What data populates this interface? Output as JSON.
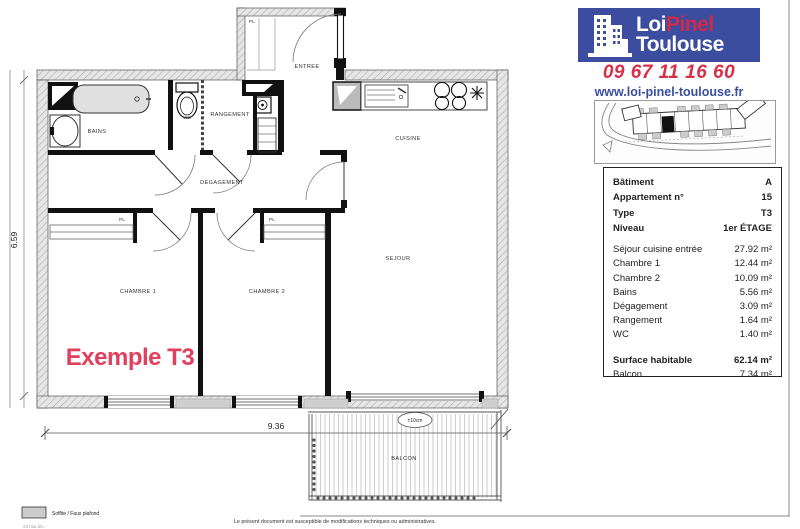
{
  "branding": {
    "logo": {
      "part1": "Loi",
      "part2": "Pinel",
      "line2": "Toulouse"
    },
    "phone": "09 67 11 16 60",
    "website": "www.loi-pinel-toulouse.fr",
    "colors": {
      "logo_bg": "#3c4c9e",
      "logo_accent": "#d02a4a",
      "phone_red": "#d82f48",
      "web_blue": "#3a4fa0",
      "watermark_red": "#e0405e"
    }
  },
  "details_table": {
    "rows": [
      {
        "label": "Bâtiment",
        "value": "A"
      },
      {
        "label": "Appartement n°",
        "value": "15"
      },
      {
        "label": "Type",
        "value": "T3"
      },
      {
        "label": "Niveau",
        "value": "1er ÉTAGE"
      },
      {
        "label": "Séjour cuisine entrée",
        "value": "27.92 m²"
      },
      {
        "label": "Chambre 1",
        "value": "12.44 m²"
      },
      {
        "label": "Chambre 2",
        "value": "10.09 m²"
      },
      {
        "label": "Bains",
        "value": "5.56 m²"
      },
      {
        "label": "Dégagement",
        "value": "3.09 m²"
      },
      {
        "label": "Rangement",
        "value": "1.64 m²"
      },
      {
        "label": "WC",
        "value": "1.40 m²"
      },
      {
        "label": "Surface habitable",
        "value": "62.14 m²"
      },
      {
        "label": "Balcon",
        "value": "7.34 m²"
      }
    ]
  },
  "floor_plan": {
    "rooms": {
      "entree": "ENTREE",
      "pl_entree": "PL",
      "bains": "BAINS",
      "wc": "WC",
      "rangement": "RANGEMENT",
      "degagement": "DEGAGEMENT",
      "cuisine": "CUISINE",
      "sejour": "SEJOUR",
      "chambre1": "CHAMBRE 1",
      "chambre2": "CHAMBRE 2",
      "pl_chambre1": "PL",
      "pl_chambre2": "PL",
      "balcon": "BALCON"
    },
    "dimensions": {
      "width_m": "9.36",
      "height_m": "6.59"
    },
    "balcony_tolerance": "±10cm",
    "watermark": "Exemple T3"
  },
  "legend": {
    "swatch_label": "Soffite / Faux plafond",
    "date_note": "23 mai 20.."
  },
  "footer": {
    "disclaimer": "Le présent document est susceptible de modifications techniques ou administratives."
  }
}
